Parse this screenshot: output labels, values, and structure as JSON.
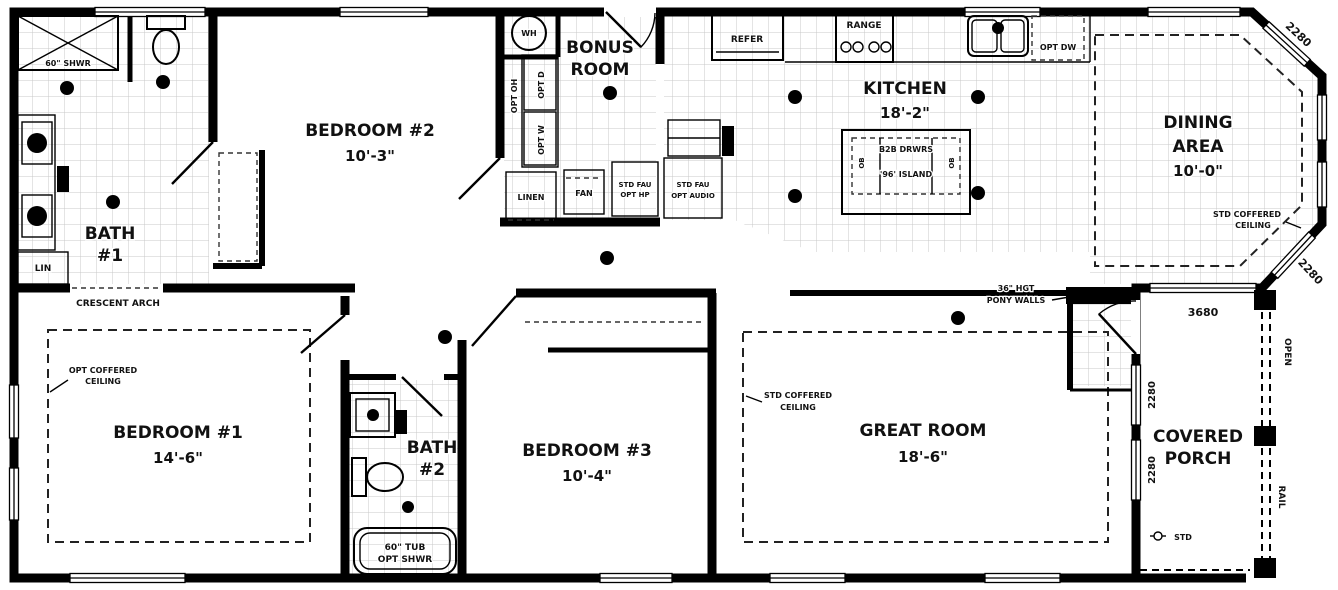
{
  "colors": {
    "wall": "#000000",
    "grid": "#c8c8c8",
    "background": "#ffffff",
    "text": "#111111"
  },
  "rooms": {
    "bath1": {
      "name": "BATH",
      "num": "#1"
    },
    "bedroom2": {
      "name": "BEDROOM #2",
      "dim": "10'-3\""
    },
    "bonus": {
      "l1": "BONUS",
      "l2": "ROOM"
    },
    "kitchen": {
      "name": "KITCHEN",
      "dim": "18'-2\""
    },
    "dining": {
      "l1": "DINING",
      "l2": "AREA",
      "dim": "10'-0\""
    },
    "bedroom1": {
      "name": "BEDROOM #1",
      "dim": "14'-6\""
    },
    "bath2": {
      "name": "BATH",
      "num": "#2"
    },
    "bedroom3": {
      "name": "BEDROOM #3",
      "dim": "10'-4\""
    },
    "great_room": {
      "name": "GREAT ROOM",
      "dim": "18'-6\""
    },
    "porch": {
      "l1": "COVERED",
      "l2": "PORCH"
    }
  },
  "fixtures": {
    "shower": "60\" SHWR",
    "lin": "LIN",
    "linen": "LINEN",
    "fan": "FAN",
    "wh": "WH",
    "opt_oh": "OPT OH",
    "opt_d": "OPT D",
    "opt_w": "OPT W",
    "fau_hp": {
      "l1": "STD FAU",
      "l2": "OPT HP"
    },
    "fau_audio": {
      "l1": "STD FAU",
      "l2": "OPT AUDIO"
    },
    "refer": "REFER",
    "range": "RANGE",
    "opt_dw": "OPT DW",
    "island": {
      "l1": "B2B DRWRS",
      "l2": "'96' ISLAND",
      "end": "OB"
    },
    "tub": {
      "l1": "60\" TUB",
      "l2": "OPT SHWR"
    },
    "porch_light": "STD"
  },
  "annotations": {
    "crescent_arch": "CRESCENT ARCH",
    "opt_coffered": {
      "l1": "OPT COFFERED",
      "l2": "CEILING"
    },
    "std_coffered": {
      "l1": "STD COFFERED",
      "l2": "CEILING"
    },
    "pony_walls": {
      "l1": "36\" HGT",
      "l2": "PONY WALLS"
    },
    "open": "OPEN",
    "rail": "RAIL"
  },
  "window_sizes": {
    "corner": "2280",
    "front": "3680"
  }
}
